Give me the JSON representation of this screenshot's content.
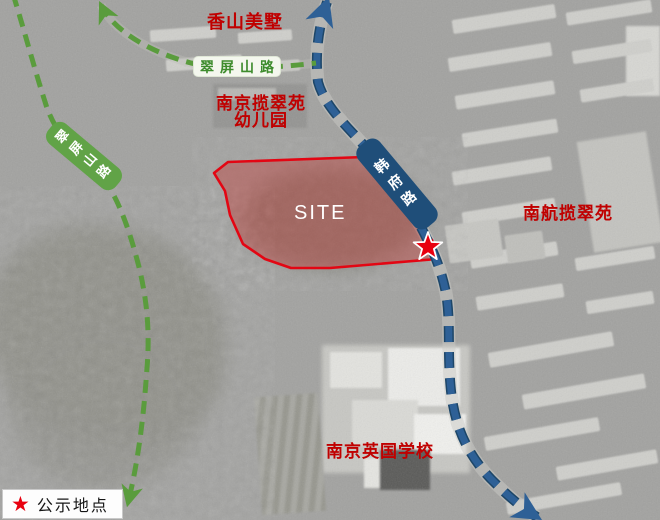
{
  "labels": {
    "estate": "香山美墅",
    "kindergarten_line1": "南京揽翠苑",
    "kindergarten_line2": "幼儿园",
    "residential": "南航揽翠苑",
    "school": "南京英国学校",
    "site": "SITE"
  },
  "roads": {
    "cuipingshan_horizontal": "翠屏山路",
    "cuipingshan_vertical": "翠屏山路",
    "hanfu": "韩府路"
  },
  "legend": {
    "star": "★",
    "label": "公示地点"
  },
  "colors": {
    "route_green": "#5a9c3d",
    "route_blue": "#2e6096",
    "route_blue_dark": "#1d4668",
    "label_green_bg": "#61a347",
    "label_blue_bg": "#1f4e79",
    "annotation_red": "#c00000",
    "site_fill": "rgba(190,75,72,0.5)",
    "site_stroke": "#e30613",
    "star_red": "#e8000f"
  }
}
